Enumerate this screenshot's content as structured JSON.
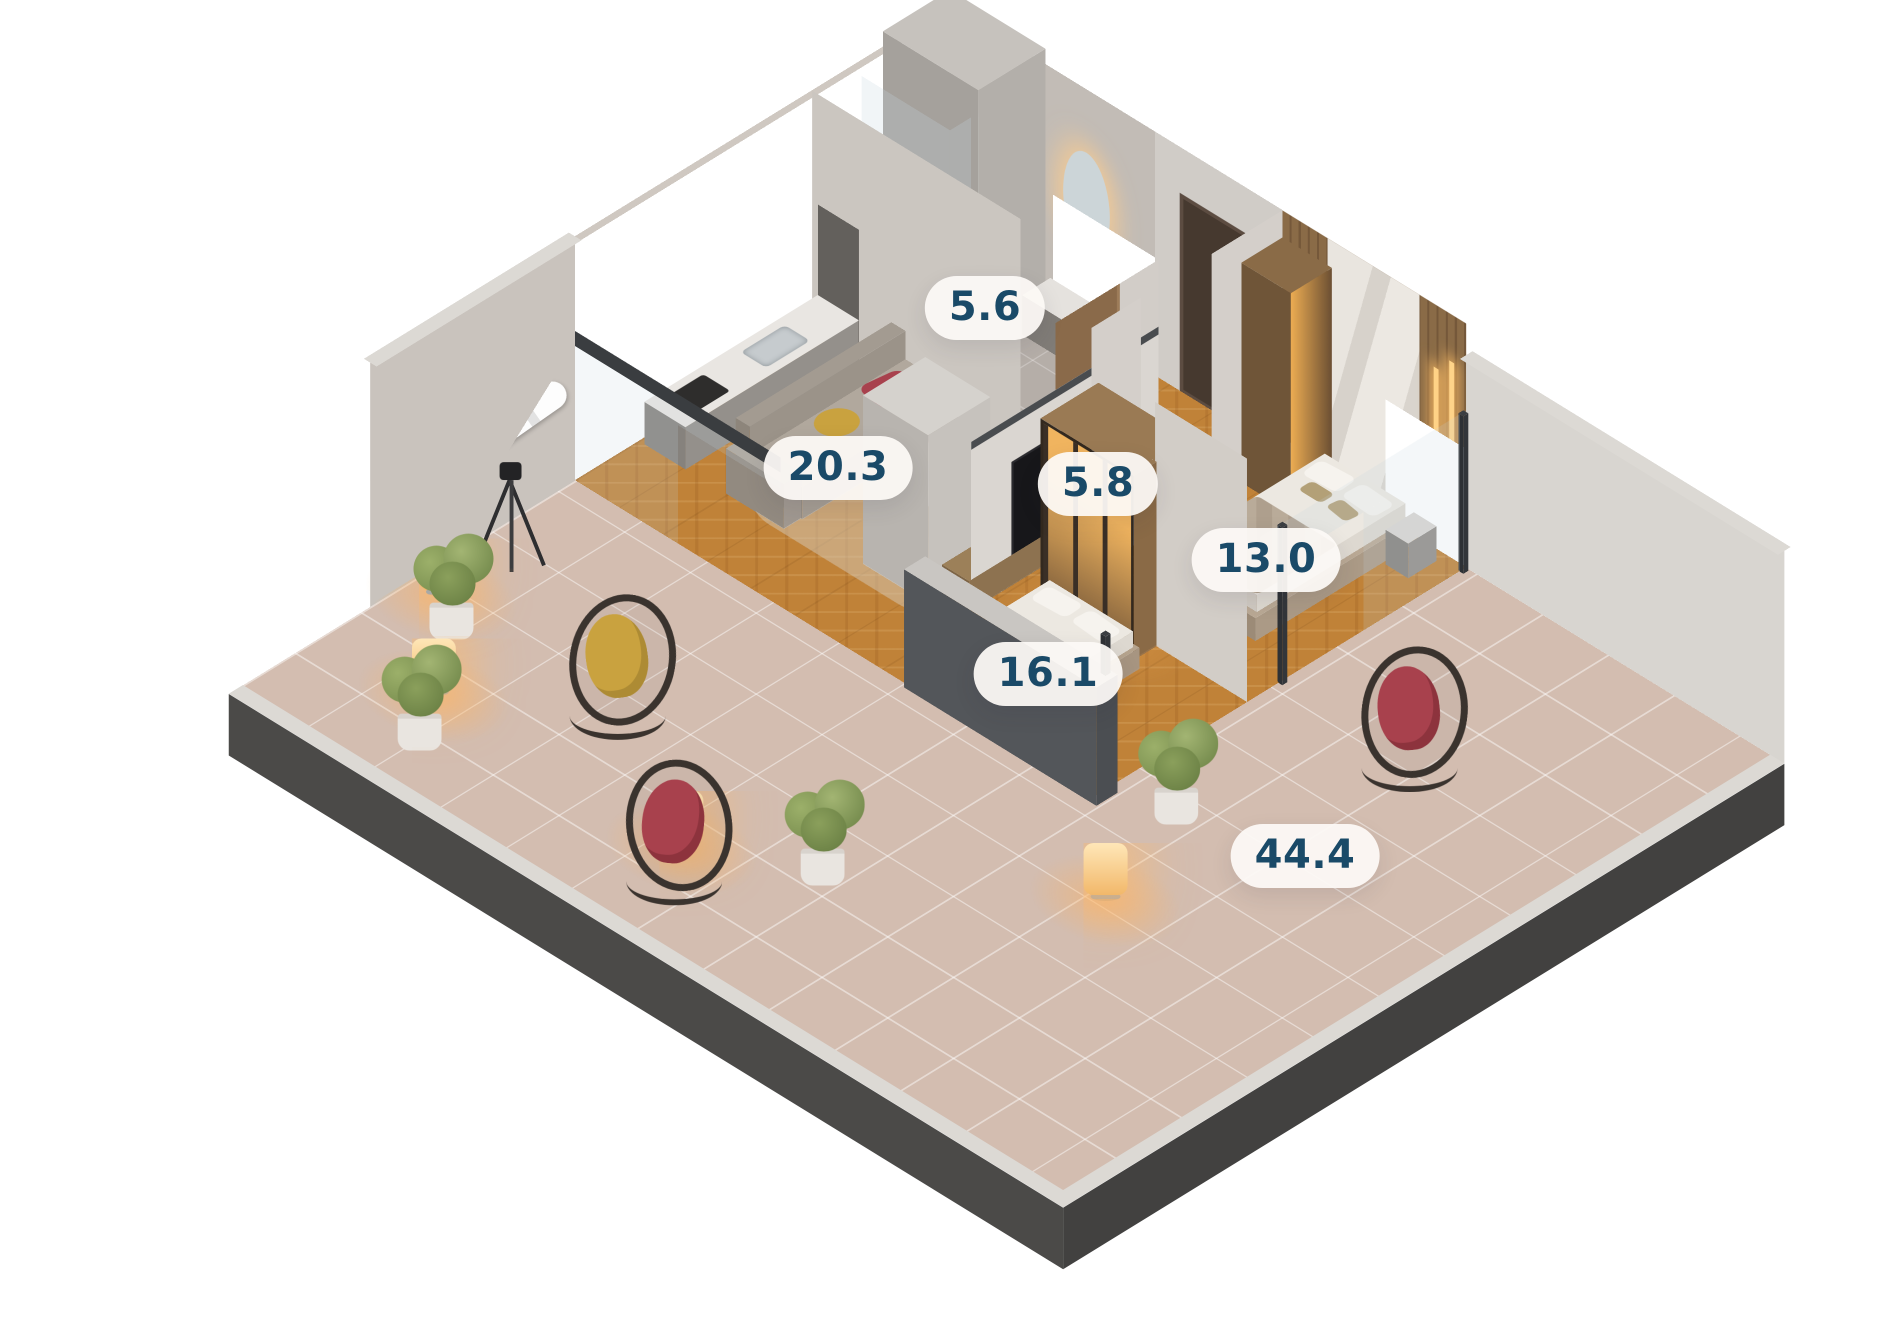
{
  "title": "3D apartment floor plan render",
  "labels": {
    "bathroom": "5.6",
    "hallway": "5.8",
    "living_kitchen": "20.3",
    "bedroom_primary": "13.0",
    "bedroom_secondary": "16.1",
    "terrace": "44.4"
  },
  "rooms": [
    {
      "id": "bathroom",
      "area": "5.6"
    },
    {
      "id": "hallway",
      "area": "5.8"
    },
    {
      "id": "living-kitchen",
      "area": "20.3"
    },
    {
      "id": "bedroom-primary",
      "area": "13.0"
    },
    {
      "id": "bedroom-secondary",
      "area": "16.1"
    },
    {
      "id": "terrace",
      "area": "44.4"
    }
  ],
  "objects": [
    "telescope",
    "kitchen-counter",
    "oven-column",
    "sofa",
    "coffee-table",
    "tv-unit",
    "tv-divider",
    "double-bed",
    "single-bed",
    "nightstands",
    "wardrobe",
    "glass-wardrobe",
    "hall-closet",
    "shower",
    "mirror",
    "floor-lamps",
    "plants",
    "hanging-egg-chairs",
    "glass-balustrade"
  ],
  "colors": {
    "label": "#1a4a68",
    "label_bg": "#fcf9f5",
    "wood": "#c08238",
    "terrace": "#d3bdb0",
    "wall": "#cfc9c3",
    "slab": "#4b4a48",
    "coping": "#dcd9d4",
    "glow": "#f2b86a",
    "red": "#a8414d",
    "yellow": "#c9a23f",
    "green": "#84975a"
  }
}
